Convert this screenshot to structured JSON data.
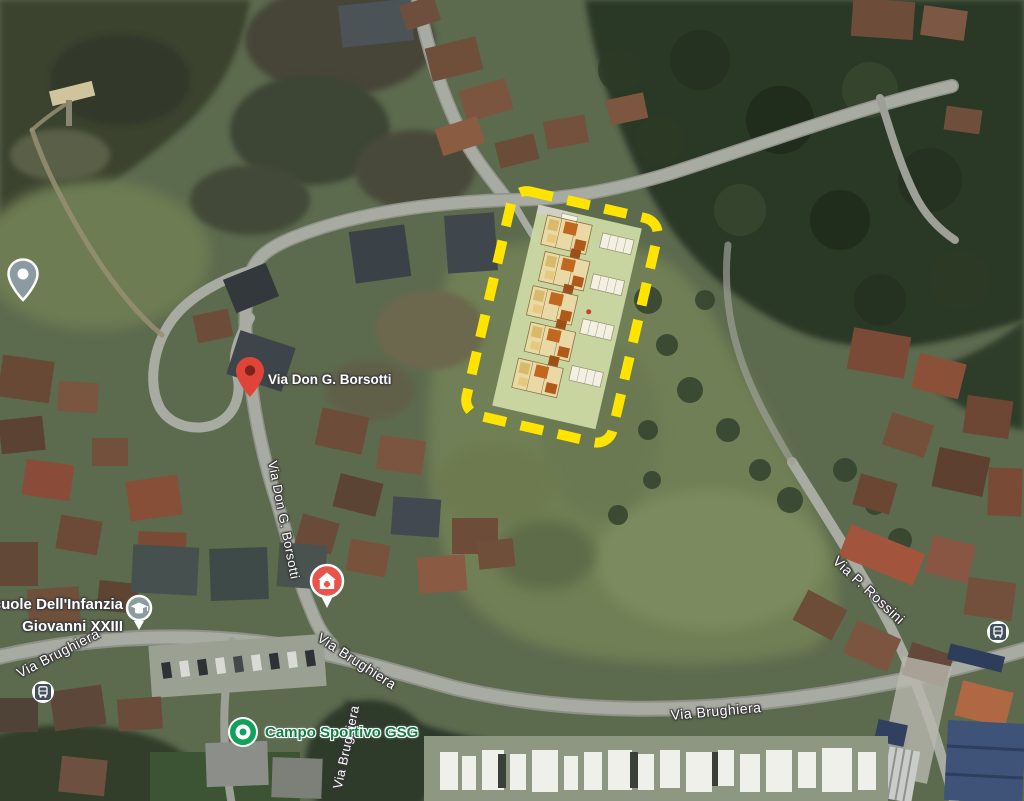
{
  "map_labels": {
    "destination_pin": "Via Don G. Borsotti",
    "street_via_don_g_borsotti": "Via Don G. Borsotti",
    "street_via_brughiera_left": "Via Brughiera",
    "street_via_brughiera_diagonal": "Via Brughiera",
    "street_via_brughiera_east": "Via Brughiera",
    "street_via_brughiera_south": "Via Brughiera",
    "street_via_p_rossini": "Via P. Rossini",
    "poi_school_line1": "Scuole Dell'Infanzia",
    "poi_school_line2": "Giovanni XXIII",
    "poi_sports": "Campo Sportivo GSG"
  },
  "icons": {
    "destination_pin": "red-map-pin",
    "poi_pin_left_edge": "gray-pin-with-dot",
    "medical_pin": "red-circle-house-cross",
    "school_pin": "graduation-cap-circle",
    "sports_pin": "green-concentric-circle",
    "bus_stop": "bus-in-rounded-square"
  },
  "colors": {
    "highlight_dash_yellow": "#ffe400",
    "site_plan_fill": "#ccd8a3",
    "building_orange": "#c2671f",
    "pin_red": "#e04438",
    "medical_red": "#e8544b",
    "school_gray": "#8a9c9e",
    "sports_green": "#10a25c",
    "bus_slate": "#41505c",
    "sports_label_green": "#0f7e44",
    "label_white": "#ffffff"
  }
}
